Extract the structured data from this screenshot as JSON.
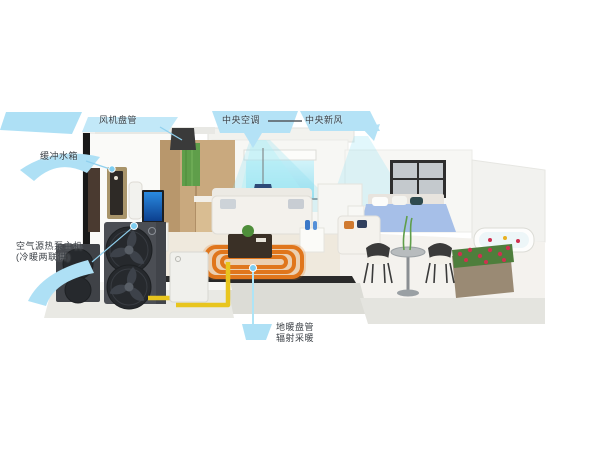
{
  "callouts": {
    "fan_coil": {
      "label": "风机盘管"
    },
    "central_ac": {
      "label": "中央空调"
    },
    "fresh_air": {
      "label": "中央新风"
    },
    "buffer_tank": {
      "label": "缓冲水箱"
    },
    "heat_pump": {
      "line1": "空气源热泵主机",
      "line2": "(冷暖两联供)"
    },
    "floor_heating": {
      "line1": "地暖盘管",
      "line2": "辐射采暖"
    }
  },
  "colors": {
    "background": "#ffffff",
    "callout_ribbon": "#aee0f5",
    "callout_ribbon_light": "#c2e8f8",
    "leader_line": "#8fd0ee",
    "marker_dot": "#7ecdf0",
    "airflow_beam": "#8ce0f2",
    "window_glow": "#c8f0f8",
    "pipe_yellow": "#e8c51e",
    "floor_coil_orange": "#e0761c",
    "heat_pump_body": "#4b4e54",
    "fan_dark": "#26292d",
    "tank_white": "#f0f0ec",
    "tv_screen_blue": "#1565c8",
    "gold_cabinet": "#a8946a",
    "wood_cabinet": "#c9a97e",
    "plant_green": "#5f9e4a",
    "bed_blue": "#a6bfe8",
    "flower_red": "#d03050"
  }
}
